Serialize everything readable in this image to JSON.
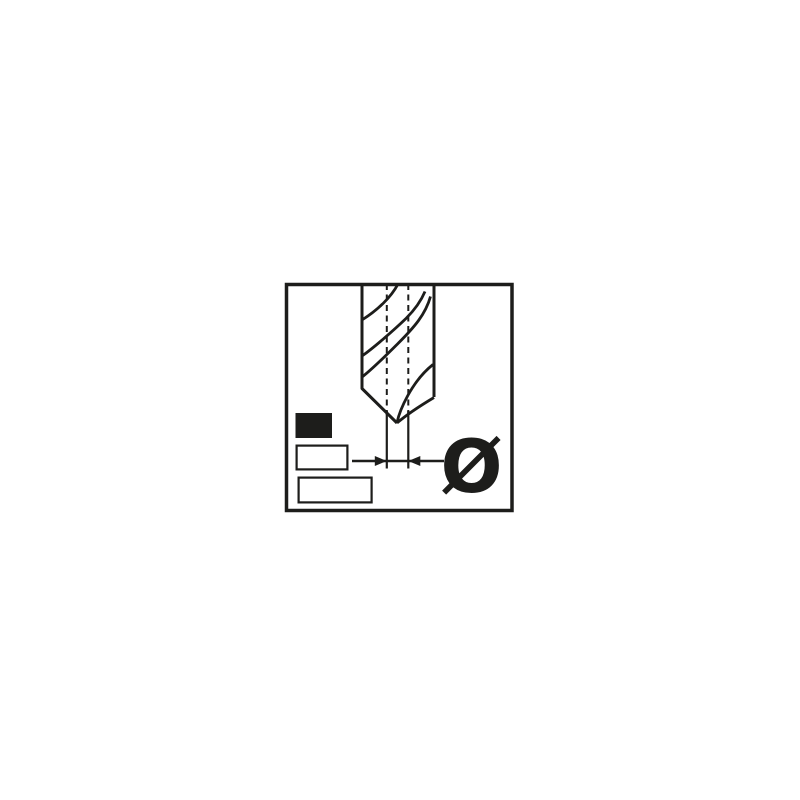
{
  "colors": {
    "ink": "#1d1d1b",
    "background": "#ffffff"
  },
  "pictogram": {
    "diameter_symbol": "Ø",
    "icons": [
      {
        "name": "drill-bit-icon",
        "shape": "twist-drill-outline"
      },
      {
        "name": "center-line-icon",
        "shape": "vertical-dashed-line"
      },
      {
        "name": "diameter-dimension-icon",
        "shape": "inward-arrows"
      },
      {
        "name": "filled-swatch-icon",
        "shape": "solid-rectangle"
      },
      {
        "name": "outlined-swatch-small-icon",
        "shape": "outline-rectangle"
      },
      {
        "name": "outlined-swatch-large-icon",
        "shape": "outline-rectangle"
      }
    ]
  }
}
